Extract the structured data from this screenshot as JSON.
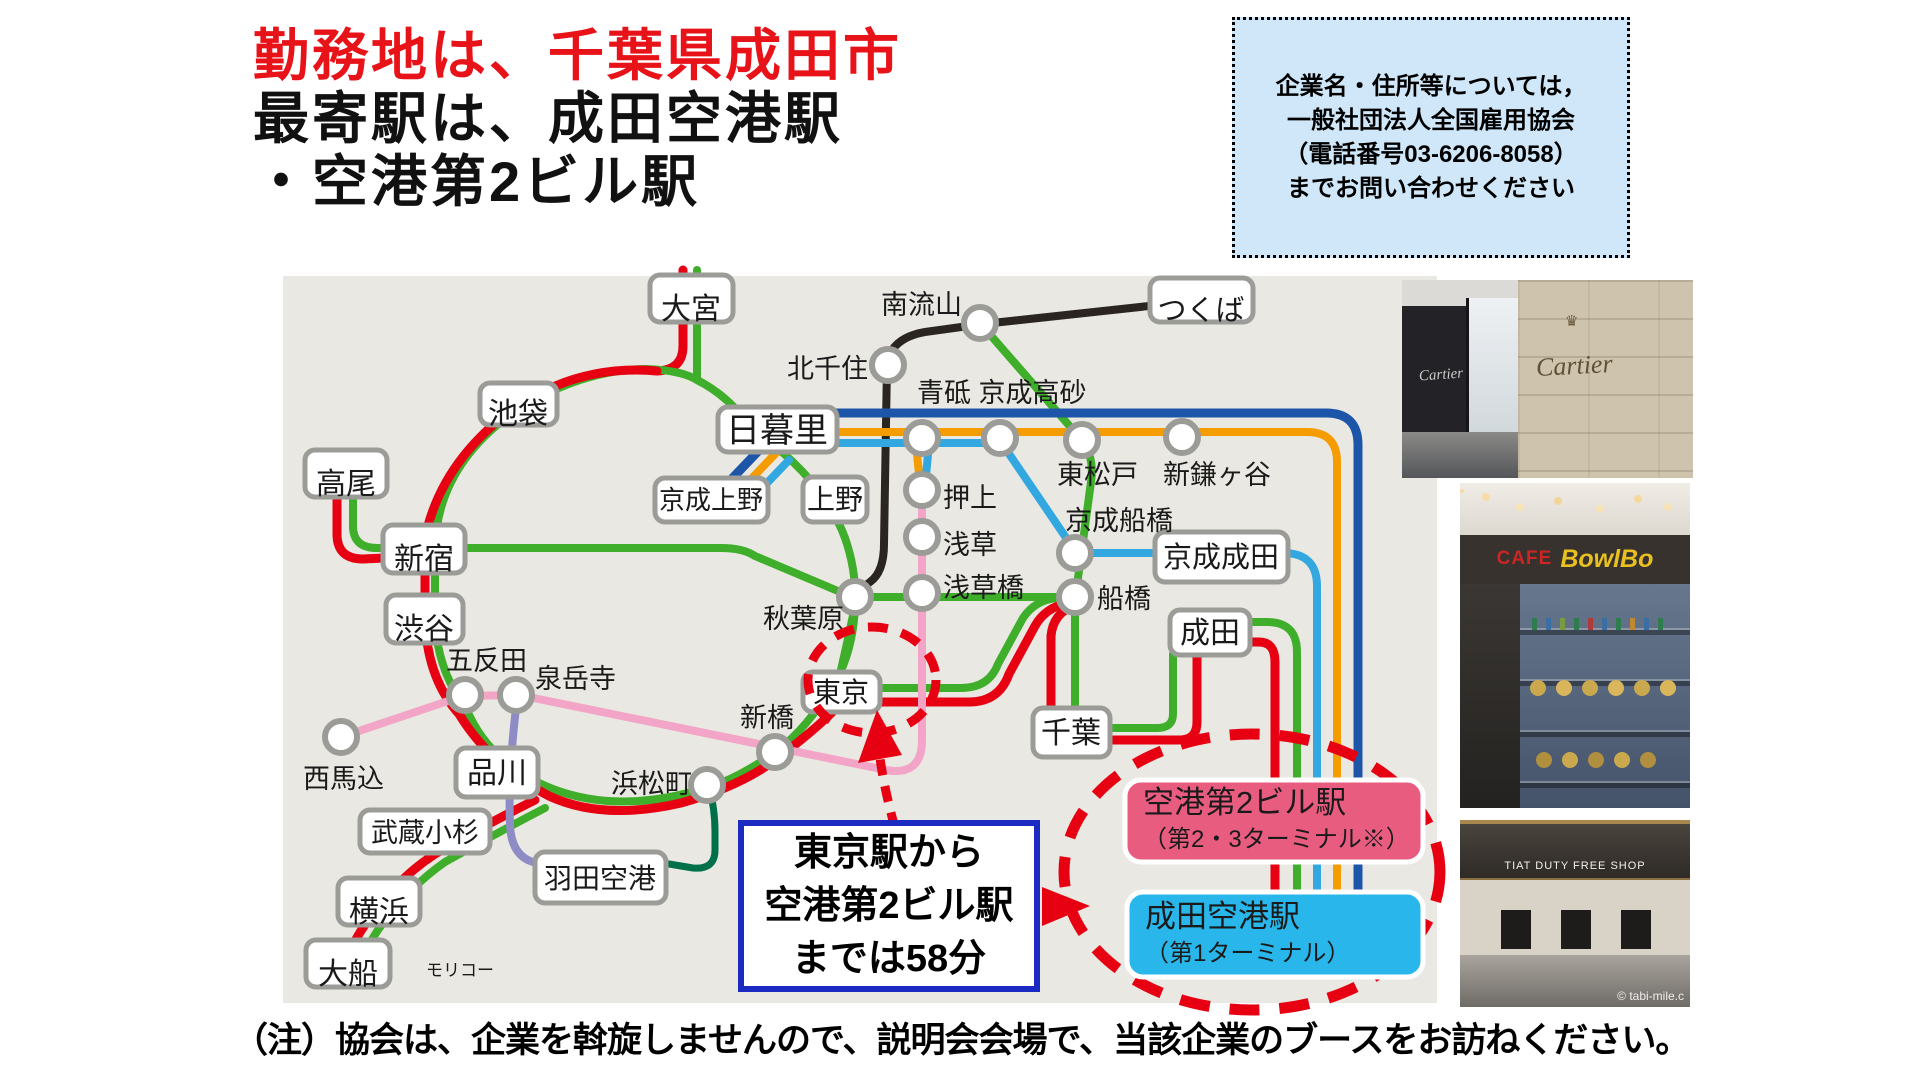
{
  "title": {
    "line1": "勤務地は、千葉県成田市",
    "line2": "最寄駅は、成田空港駅",
    "line3": "・空港第2ビル駅",
    "accent_color": "#e81219"
  },
  "contact_box": {
    "line1": "企業名・住所等については，",
    "line2": "一般社団法人全国雇用協会",
    "line3": "（電話番号03-6206-8058）",
    "line4": "までお問い合わせください"
  },
  "callout": {
    "line1": "東京駅から",
    "line2": "空港第2ビル駅",
    "line3": "までは58分",
    "border_color": "#1b2ac1"
  },
  "airport_boxes": {
    "terminal2": {
      "title": "空港第2ビル駅",
      "subtitle": "（第2・3ターミナル※）",
      "color": "#e85c80"
    },
    "terminal1": {
      "title": "成田空港駅",
      "subtitle": "（第1ターミナル）",
      "color": "#29b7eb"
    }
  },
  "footer": {
    "note": "（注）協会は、企業を斡旋しませんので、説明会会場で、当該企業のブースをお訪ねください。"
  },
  "map": {
    "background": "#e9e8e2",
    "line_colors": {
      "jr_red": "#e60012",
      "jr_green": "#3fae2a",
      "monorail_dark_green": "#00704b",
      "tsukuba_express_black": "#2b2522",
      "asakusa_line_pink": "#f2a5c6",
      "keikyu_purple": "#8f8cc5",
      "keisei_light_blue": "#33a8e0",
      "skyliner_orange": "#f59c00",
      "access_blue": "#1d56a8"
    },
    "boxed": {
      "omiya": "大宮",
      "tsukuba": "つくば",
      "ikebukuro": "池袋",
      "takao": "高尾",
      "shinjuku": "新宿",
      "shibuya": "渋谷",
      "nippori": "日暮里",
      "keisei_ueno": "京成上野",
      "ueno": "上野",
      "keisei_narita": "京成成田",
      "narita": "成田",
      "chiba": "千葉",
      "tokyo": "東京",
      "shinagawa": "品川",
      "musashi_kosugi": "武蔵小杉",
      "yokohama": "横浜",
      "ofuna": "大船",
      "haneda": "羽田空港"
    },
    "plain": {
      "minami_nagareyama": "南流山",
      "kita_senju": "北千住",
      "aoto_takasago": "青砥 京成高砂",
      "higashi_matsudo": "東松戸",
      "shin_kamagaya": "新鎌ヶ谷",
      "keisei_funabashi": "京成船橋",
      "oshiage": "押上",
      "asakusa": "浅草",
      "asakusabashi": "浅草橋",
      "funabashi": "船橋",
      "akihabara": "秋葉原",
      "gotanda": "五反田",
      "sengakuji": "泉岳寺",
      "nishi_magome": "西馬込",
      "shimbashi": "新橋",
      "hamamatsucho": "浜松町"
    },
    "watermark": "モリコー"
  },
  "photos": {
    "cartier": {
      "sign_left": "Cartier",
      "sign_right": "Cartier",
      "crown_icon": "♛"
    },
    "cafe": {
      "sign_cafe": "CAFE",
      "sign_bowl": "BowlBo"
    },
    "dutyfree": {
      "sign": "TIAT DUTY FREE SHOP",
      "watermark": "© tabi-mile.c"
    }
  }
}
